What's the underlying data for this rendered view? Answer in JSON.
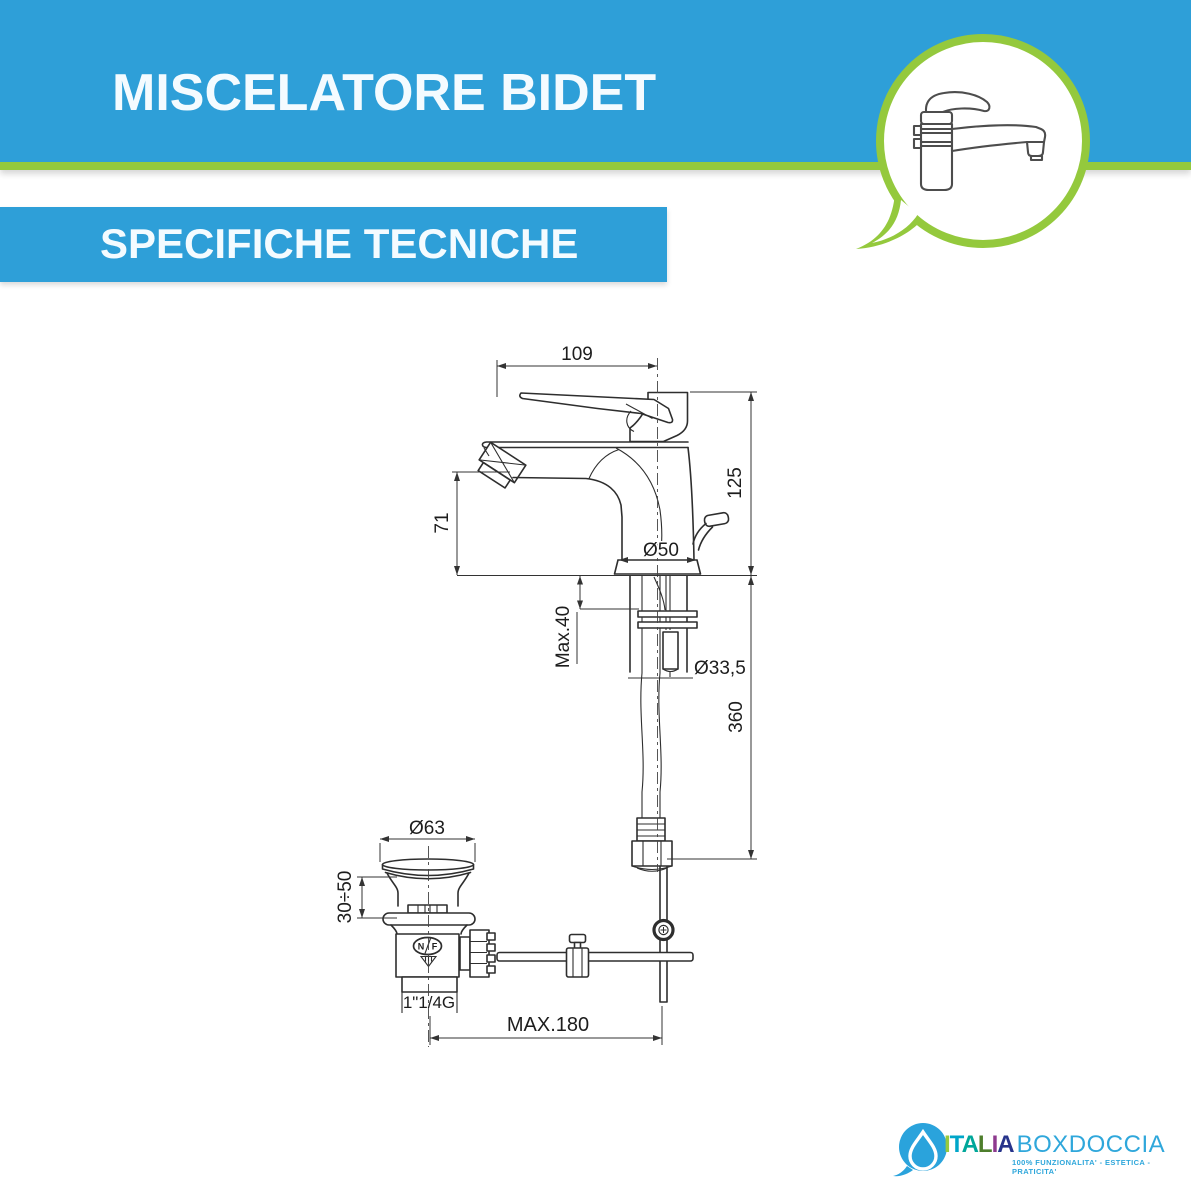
{
  "header": {
    "title": "MISCELATORE BIDET",
    "subtitle": "SPECIFICHE TECNICHE",
    "bar_color": "#2E9FD8",
    "accent_color": "#94C93D"
  },
  "drawing": {
    "line_color": "#2e2e2e",
    "labels": {
      "spout_reach": "109",
      "total_height": "125",
      "spout_height": "71",
      "base_diameter": "Ø50",
      "deck_thickness": "Max.40",
      "shank_diameter": "Ø33,5",
      "hose_length": "360",
      "drain_cap_diameter": "Ø63",
      "drain_adjust_range": "30÷50",
      "drain_thread": "1\"1/4G",
      "rod_reach": "MAX.180",
      "cert_n": "N",
      "cert_f": "F"
    }
  },
  "footer_logo": {
    "bubble_color": "#2AA3DC",
    "brand_letters": [
      {
        "ch": "I",
        "color": "#97C93D"
      },
      {
        "ch": "T",
        "color": "#00A6C9"
      },
      {
        "ch": "A",
        "color": "#00A79A"
      },
      {
        "ch": "L",
        "color": "#4E7E2C"
      },
      {
        "ch": "I",
        "color": "#8E3A8E"
      },
      {
        "ch": "A",
        "color": "#27348B"
      }
    ],
    "brand_suffix": "BOXDOCCIA",
    "suffix_color": "#2FA7DB",
    "tagline": "100% FUNZIONALITA' - ESTETICA - PRATICITA'"
  }
}
